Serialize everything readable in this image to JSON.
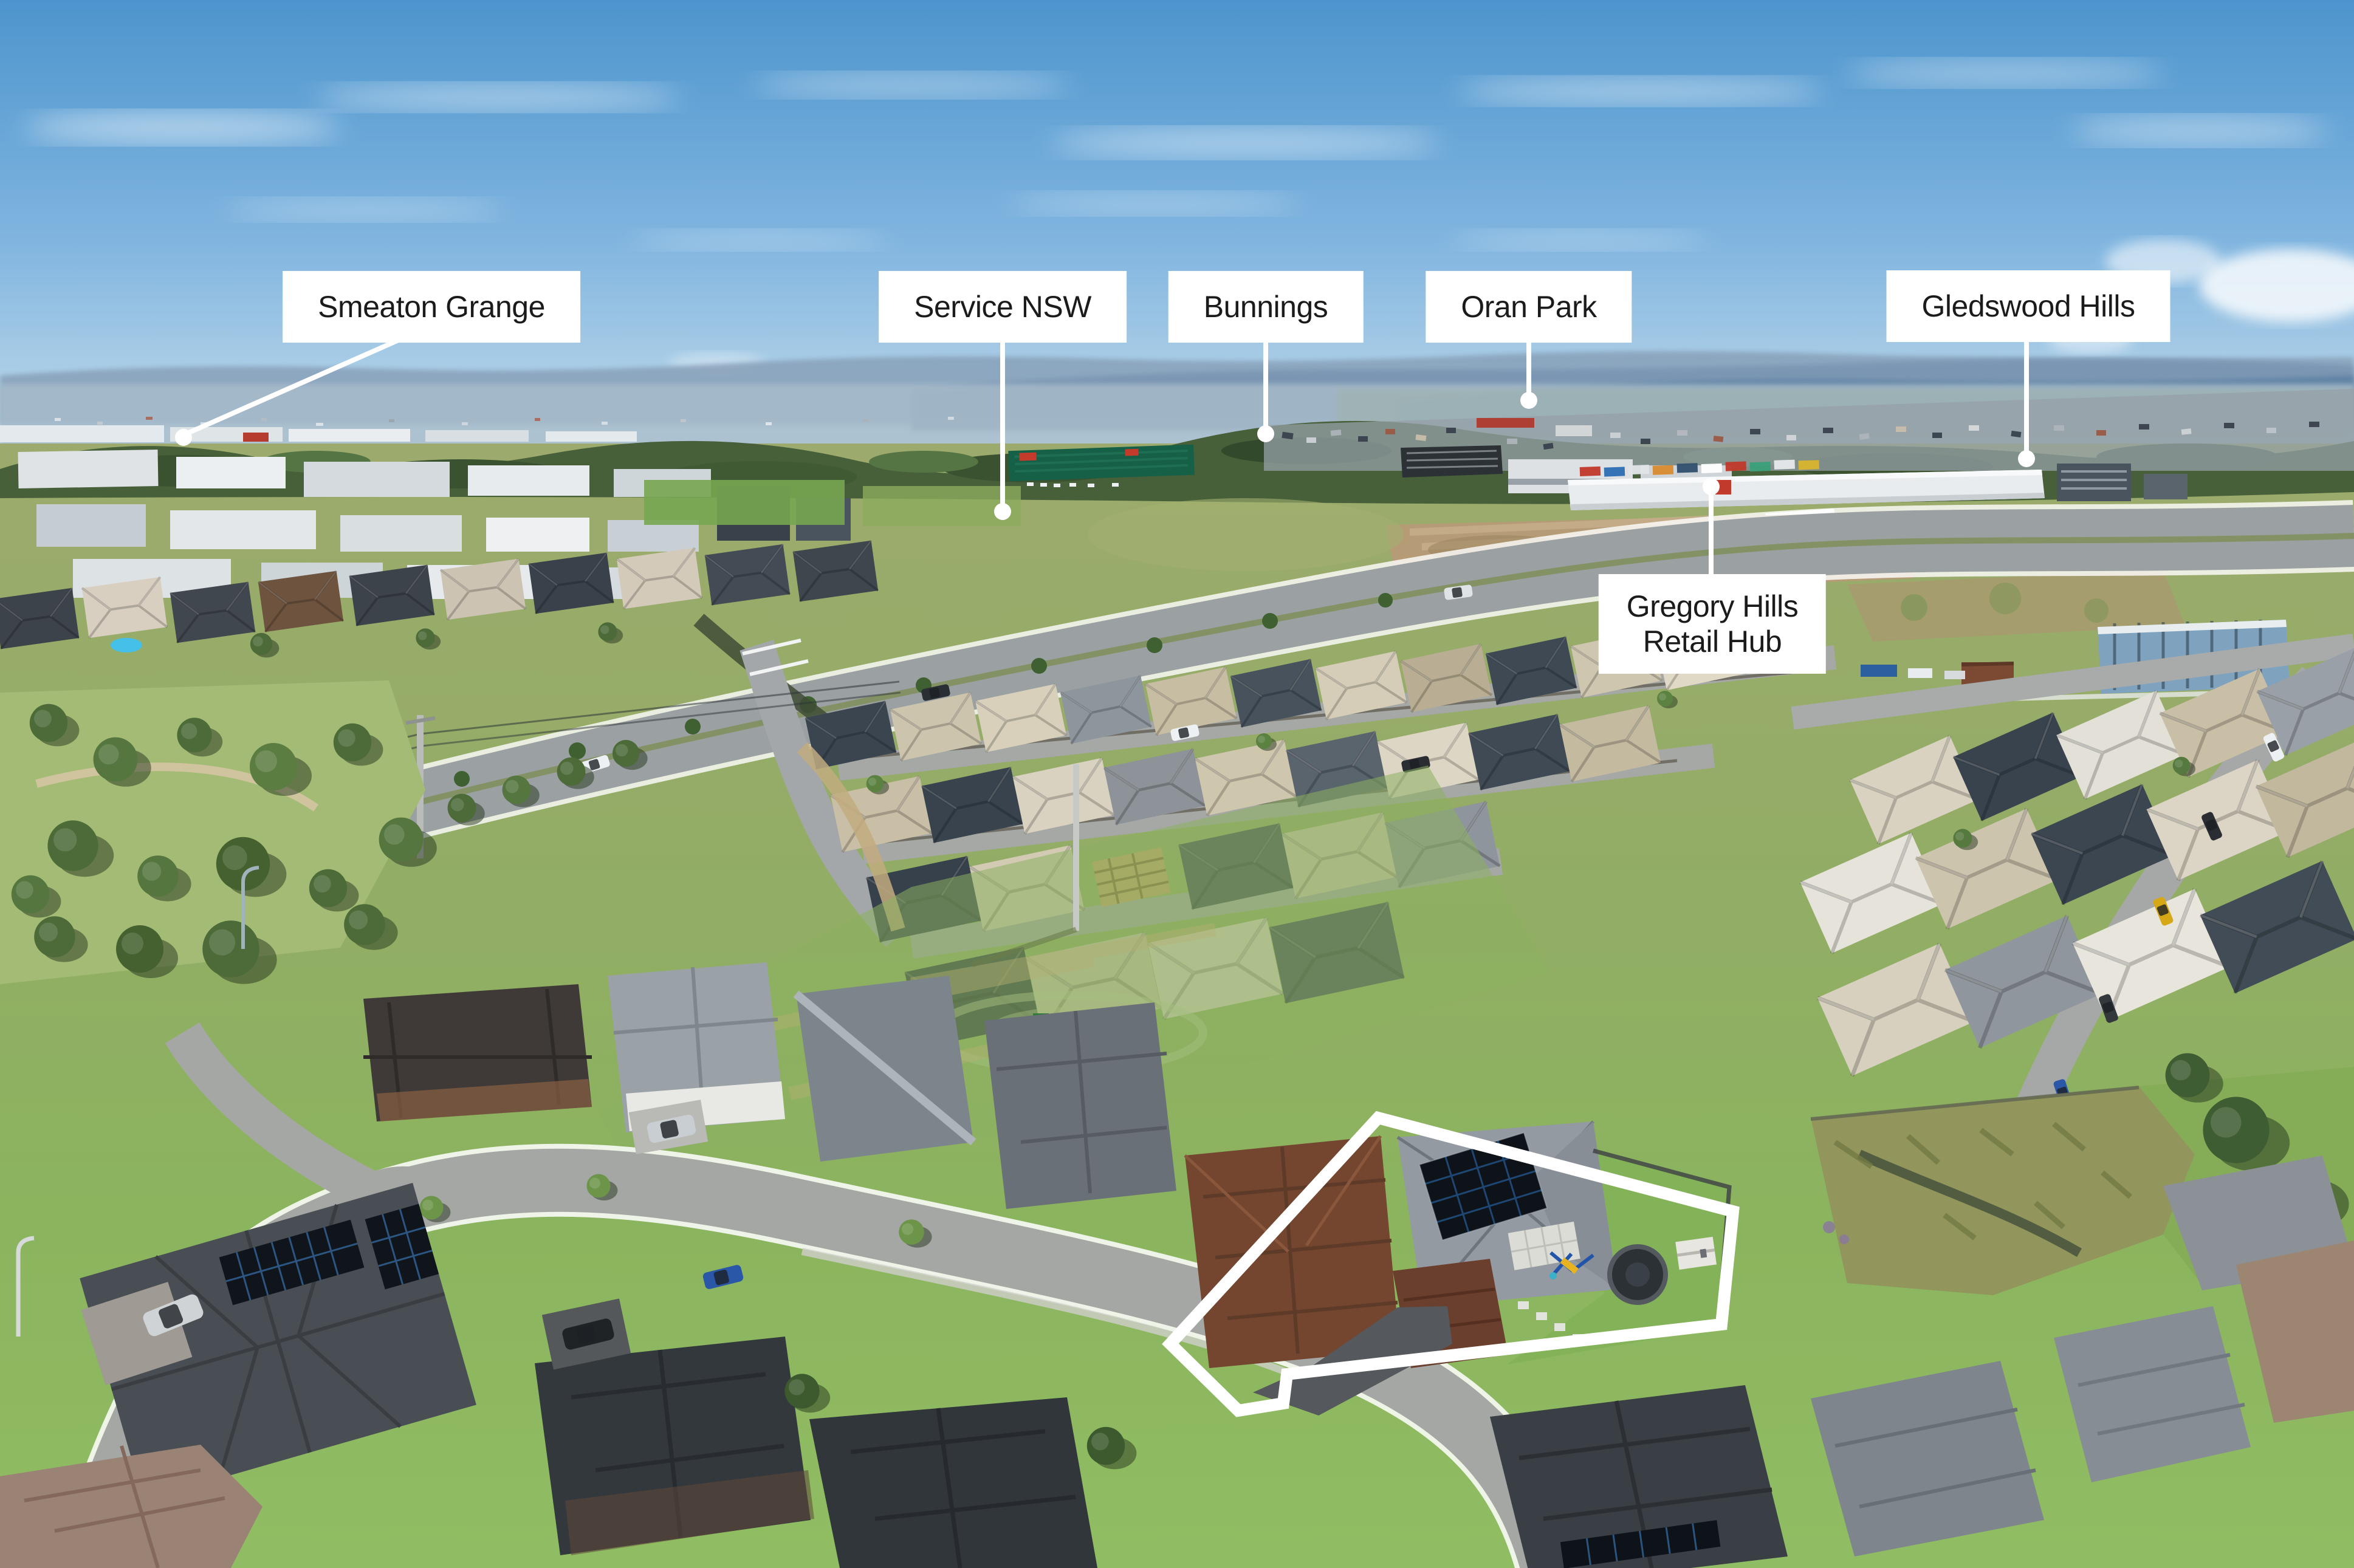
{
  "photo": {
    "kind": "aerial-drone-photograph-with-location-callouts",
    "location_labels": [
      {
        "text": "Smeaton Grange"
      },
      {
        "text": "Service NSW"
      },
      {
        "text": "Bunnings"
      },
      {
        "text": "Oran Park"
      },
      {
        "text": "Gledswood Hills"
      },
      {
        "line1": "Gregory Hills",
        "line2": "Retail Hub"
      }
    ],
    "highlighted_property_outline": true,
    "colors": {
      "label_background": "#ffffff",
      "label_text": "#1b1b1d",
      "leader_line": "#ffffff",
      "boundary_outline": "#ffffff",
      "sky_top": "#4d95cd",
      "sky_horizon": "#d8e7ef",
      "mountains": "#7a95b2",
      "grass": "#8fbc62",
      "dirt": "#b59c76",
      "road": "#9ba0a2"
    }
  }
}
